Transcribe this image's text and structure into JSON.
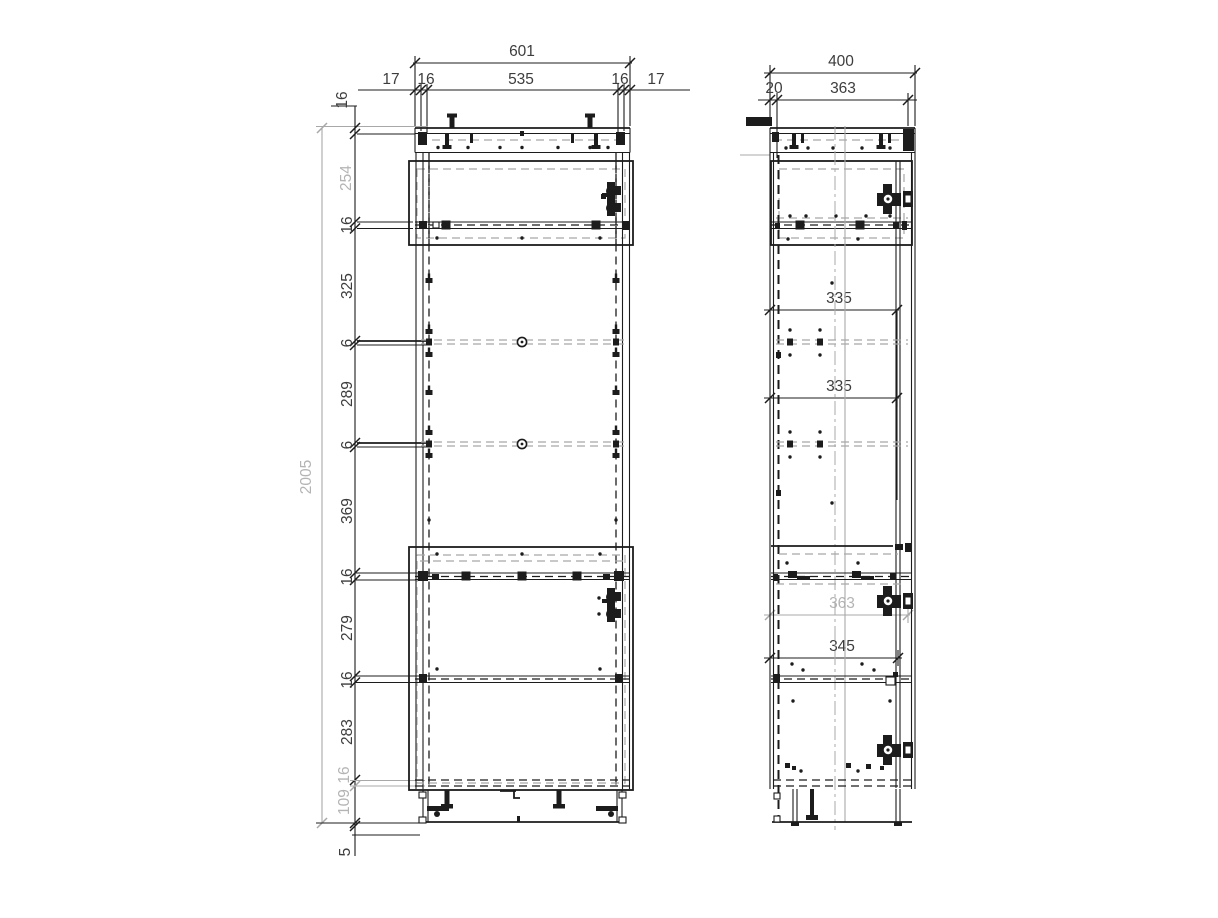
{
  "colors": {
    "line": "#1c1c1c",
    "gray": "#a8a8a8",
    "text": "#3d3d3d",
    "textGray": "#b4b4b4",
    "background": "#ffffff"
  },
  "front_view": {
    "overall_width": "601",
    "width_chain": [
      "17",
      "16",
      "535",
      "16",
      "17"
    ],
    "overall_height": "2005",
    "height_chain": [
      "16",
      "254",
      "16",
      "325",
      "6",
      "289",
      "6",
      "369",
      "16",
      "279",
      "16",
      "283",
      "16",
      "109",
      "5"
    ]
  },
  "side_view": {
    "overall_depth": "400",
    "depth_chain": [
      "20",
      "363"
    ],
    "internal_depths": [
      "335",
      "335",
      "363",
      "345"
    ]
  }
}
